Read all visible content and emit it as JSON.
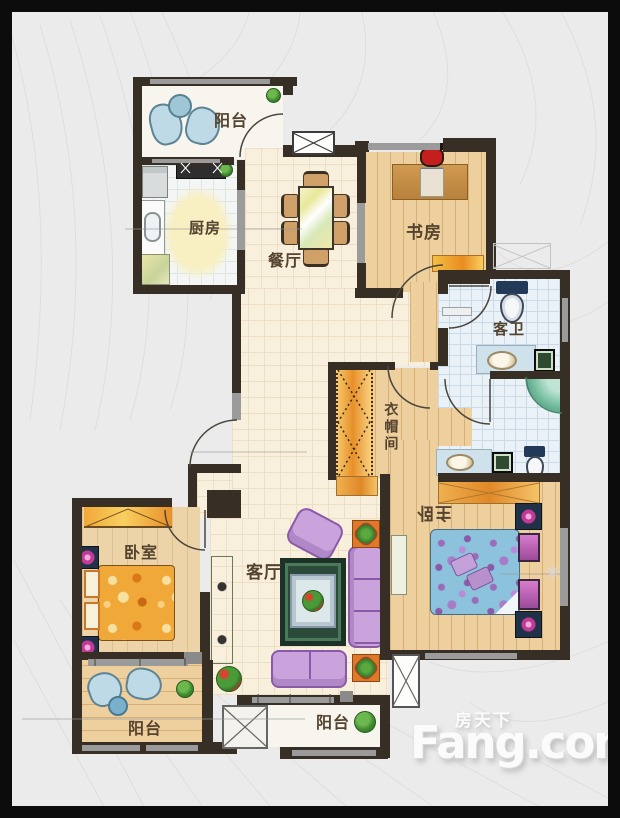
{
  "rooms": {
    "balcony_top": "阳台",
    "kitchen": "厨房",
    "dining": "餐厅",
    "study": "书房",
    "guest_bath": "客卫",
    "closet": "衣帽间",
    "master_bedroom": "主卧",
    "bedroom": "卧室",
    "living": "客厅",
    "balcony_left": "阳台",
    "balcony_middle": "阳台"
  },
  "watermark": {
    "brand_cn": "房天下",
    "brand_en": "Fang.com"
  },
  "palette": {
    "frame": "#0c0c0c",
    "background": "#ebebeb",
    "wall": "#372e25",
    "window": "#9b9b9b",
    "wood_floor": "#eecf9e",
    "beige_tile": "#f8efdc",
    "bath_tile": "#eaf2f8",
    "label_text": "#54432f",
    "sofa_purple": "#cba3dc",
    "bed_orange": "#f0a838",
    "bed_blue": "#8cc2dc",
    "plant_green": "#3f8a2f",
    "watermark_text": "#fbfbfb"
  }
}
